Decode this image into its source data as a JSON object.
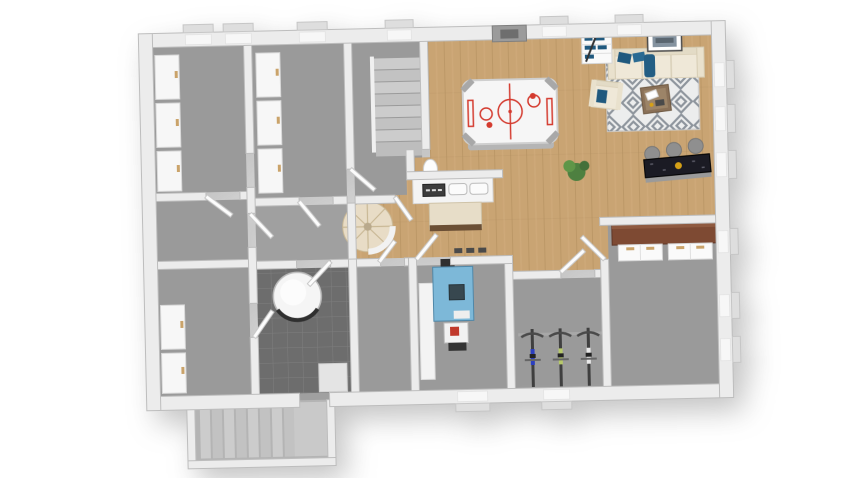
{
  "scene": {
    "title": "3D rendered basement floor plan, top-down dollhouse view",
    "background": "#ffffff"
  },
  "palette": {
    "wall_fill": "#ececec",
    "wall_stroke": "#bdbdbd",
    "concrete_floor": "#9a9a9a",
    "corridor_floor": "#a0a0a0",
    "wood_floor": "#c9a473",
    "wood_grain": "#b08b5c",
    "tile_floor": "#6d6d6d",
    "tile_grout": "#808080",
    "rug_base": "#eceded",
    "rug_pattern": "#8e959d",
    "sofa_cream": "#efe8d8",
    "pillow_blue": "#20597e",
    "coffee_table_brown": "#8a7158",
    "counter_brown": "#7e4a33",
    "bar_black": "#1b1b24",
    "stool_gray": "#8f8f8f",
    "boiler_blue": "#7db8d8",
    "plant_green": "#4e8040",
    "plant_green_light": "#5f9648",
    "stair_beige": "#e8dcc6",
    "bike_blue": "#2b3fbf",
    "bike_green": "#b6c86a",
    "bike_white": "#e9e9e9",
    "accent_red": "#d43b2f",
    "accent_gold": "#d4a017",
    "tan_handle": "#caa36a"
  },
  "rooms": [
    {
      "id": "storage-1",
      "name": "Storage room north-west",
      "floor": "concrete"
    },
    {
      "id": "storage-2",
      "name": "Storage room north",
      "floor": "concrete"
    },
    {
      "id": "stair-hall",
      "name": "Staircase hall with straight stairs",
      "floor": "concrete"
    },
    {
      "id": "rec-room",
      "name": "Recreation room with lounge and bar",
      "floor": "wood"
    },
    {
      "id": "storage-3",
      "name": "Storage room west",
      "floor": "concrete"
    },
    {
      "id": "storage-4",
      "name": "Storage room south-west",
      "floor": "concrete"
    },
    {
      "id": "corridor",
      "name": "Corridor",
      "floor": "concrete"
    },
    {
      "id": "utility",
      "name": "Utility room with water heater",
      "floor": "dark tile"
    },
    {
      "id": "small-room",
      "name": "Small room",
      "floor": "concrete"
    },
    {
      "id": "boiler-room",
      "name": "Boiler room",
      "floor": "concrete"
    },
    {
      "id": "bike-storage",
      "name": "Bike storage",
      "floor": "concrete"
    },
    {
      "id": "workshop",
      "name": "Hobby room with counter",
      "floor": "concrete"
    },
    {
      "id": "exterior-stairwell",
      "name": "Exterior cellar stairwell",
      "floor": "concrete"
    }
  ],
  "furniture": [
    "air-hockey-table",
    "sofa",
    "armchair",
    "coffee-table",
    "area-rug",
    "bookshelf",
    "wall-art",
    "bar-counter",
    "bar-stools",
    "potted-plant",
    "kitchenette-counter",
    "side-table",
    "pedestal",
    "counter-with-cabinets",
    "boiler-unit",
    "water-heater-tank",
    "bicycle-blue",
    "bicycle-green",
    "bicycle-white",
    "spiral-staircase",
    "straight-staircase",
    "storage-shelves",
    "door-leaves",
    "windows",
    "wall-hatch"
  ],
  "openings": {
    "top_windows": 6,
    "right_windows": 6,
    "bottom_windows": 2,
    "interior_doors": 11
  }
}
